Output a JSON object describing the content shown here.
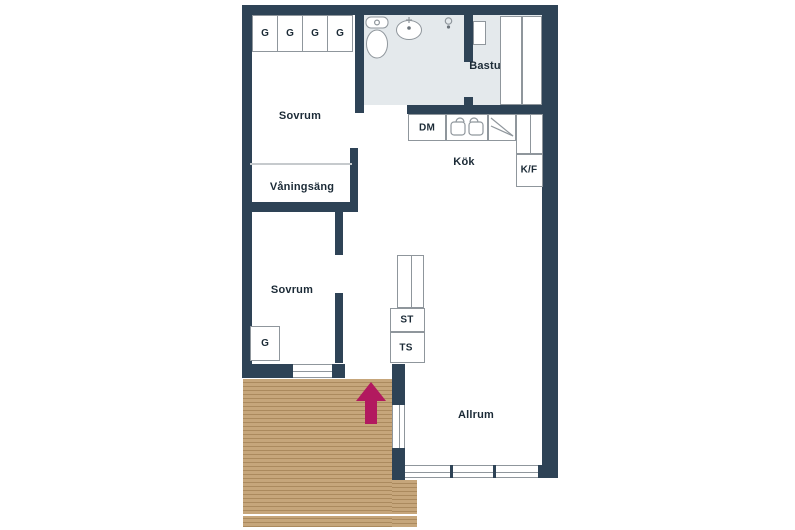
{
  "plan": {
    "type": "apartment-floor-plan",
    "language": "sv",
    "rooms": {
      "bedroom_top": {
        "label": "Sovrum"
      },
      "bunk_alcove": {
        "label": "Våningsäng"
      },
      "bedroom_bottom": {
        "label": "Sovrum"
      },
      "sauna": {
        "label": "Bastu"
      },
      "kitchen": {
        "label": "Kök"
      },
      "living_room": {
        "label": "Allrum"
      }
    },
    "closets": {
      "top_row": [
        "G",
        "G",
        "G",
        "G"
      ],
      "bedroom_bottom": {
        "label": "G"
      }
    },
    "units": {
      "dishwasher": {
        "label": "DM"
      },
      "fridge_freezer": {
        "label": "K/F"
      },
      "cleaning_cabinet": {
        "label": "ST"
      },
      "drying_cabinet": {
        "label": "TS"
      }
    },
    "icons": {
      "toilet": "toilet-icon",
      "sink": "sink-icon",
      "shower": "shower-mixer-icon",
      "sauna_heater": "sauna-heater-icon",
      "kitchen_sink": "kitchen-sink-icon",
      "stove": "stove-icon",
      "entrance_arrow": "entrance-arrow-icon"
    },
    "colors": {
      "wall": "#2e4356",
      "wet_floor": "#e4e9ec",
      "deck": "#c6a67b",
      "deck_stripe": "#ab8a5e",
      "arrow": "#b2195f",
      "outline": "#8f969c",
      "text": "#1b2a36"
    }
  }
}
